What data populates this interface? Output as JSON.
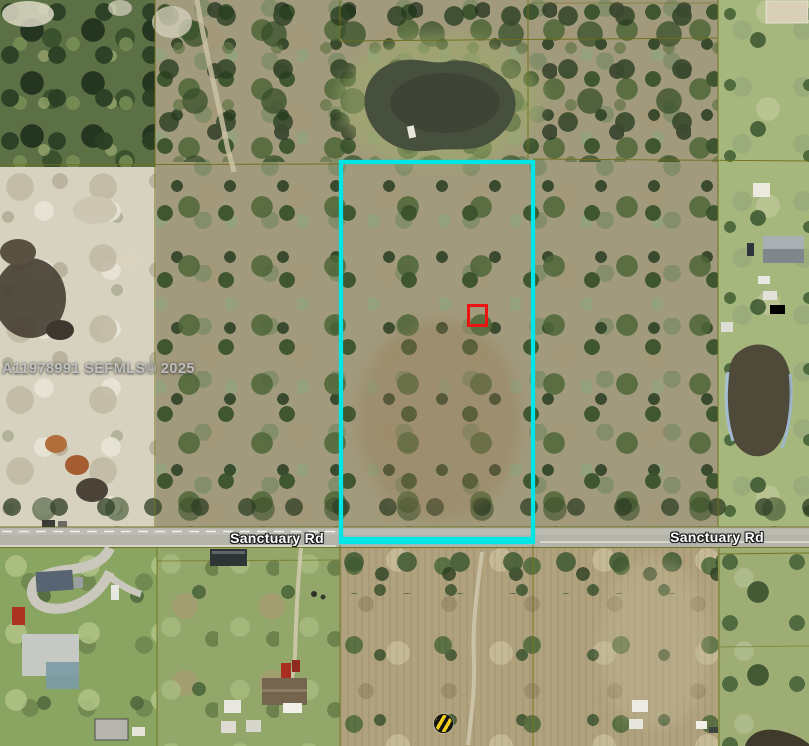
{
  "map": {
    "watermark": "A11978991 SEFMLS© 2025",
    "road_labels": [
      "Sanctuary Rd",
      "Sanctuary Rd"
    ],
    "marker_colors": {
      "property_boundary": "#00e6e6",
      "subject_marker": "#ec1212",
      "parcel_line": "#6f6f1a",
      "road_surface": "#b4b4aa",
      "road_label_text": "#ffffff",
      "hazard_marker_yellow": "#f0cf1c",
      "hazard_marker_black": "#151515"
    }
  }
}
